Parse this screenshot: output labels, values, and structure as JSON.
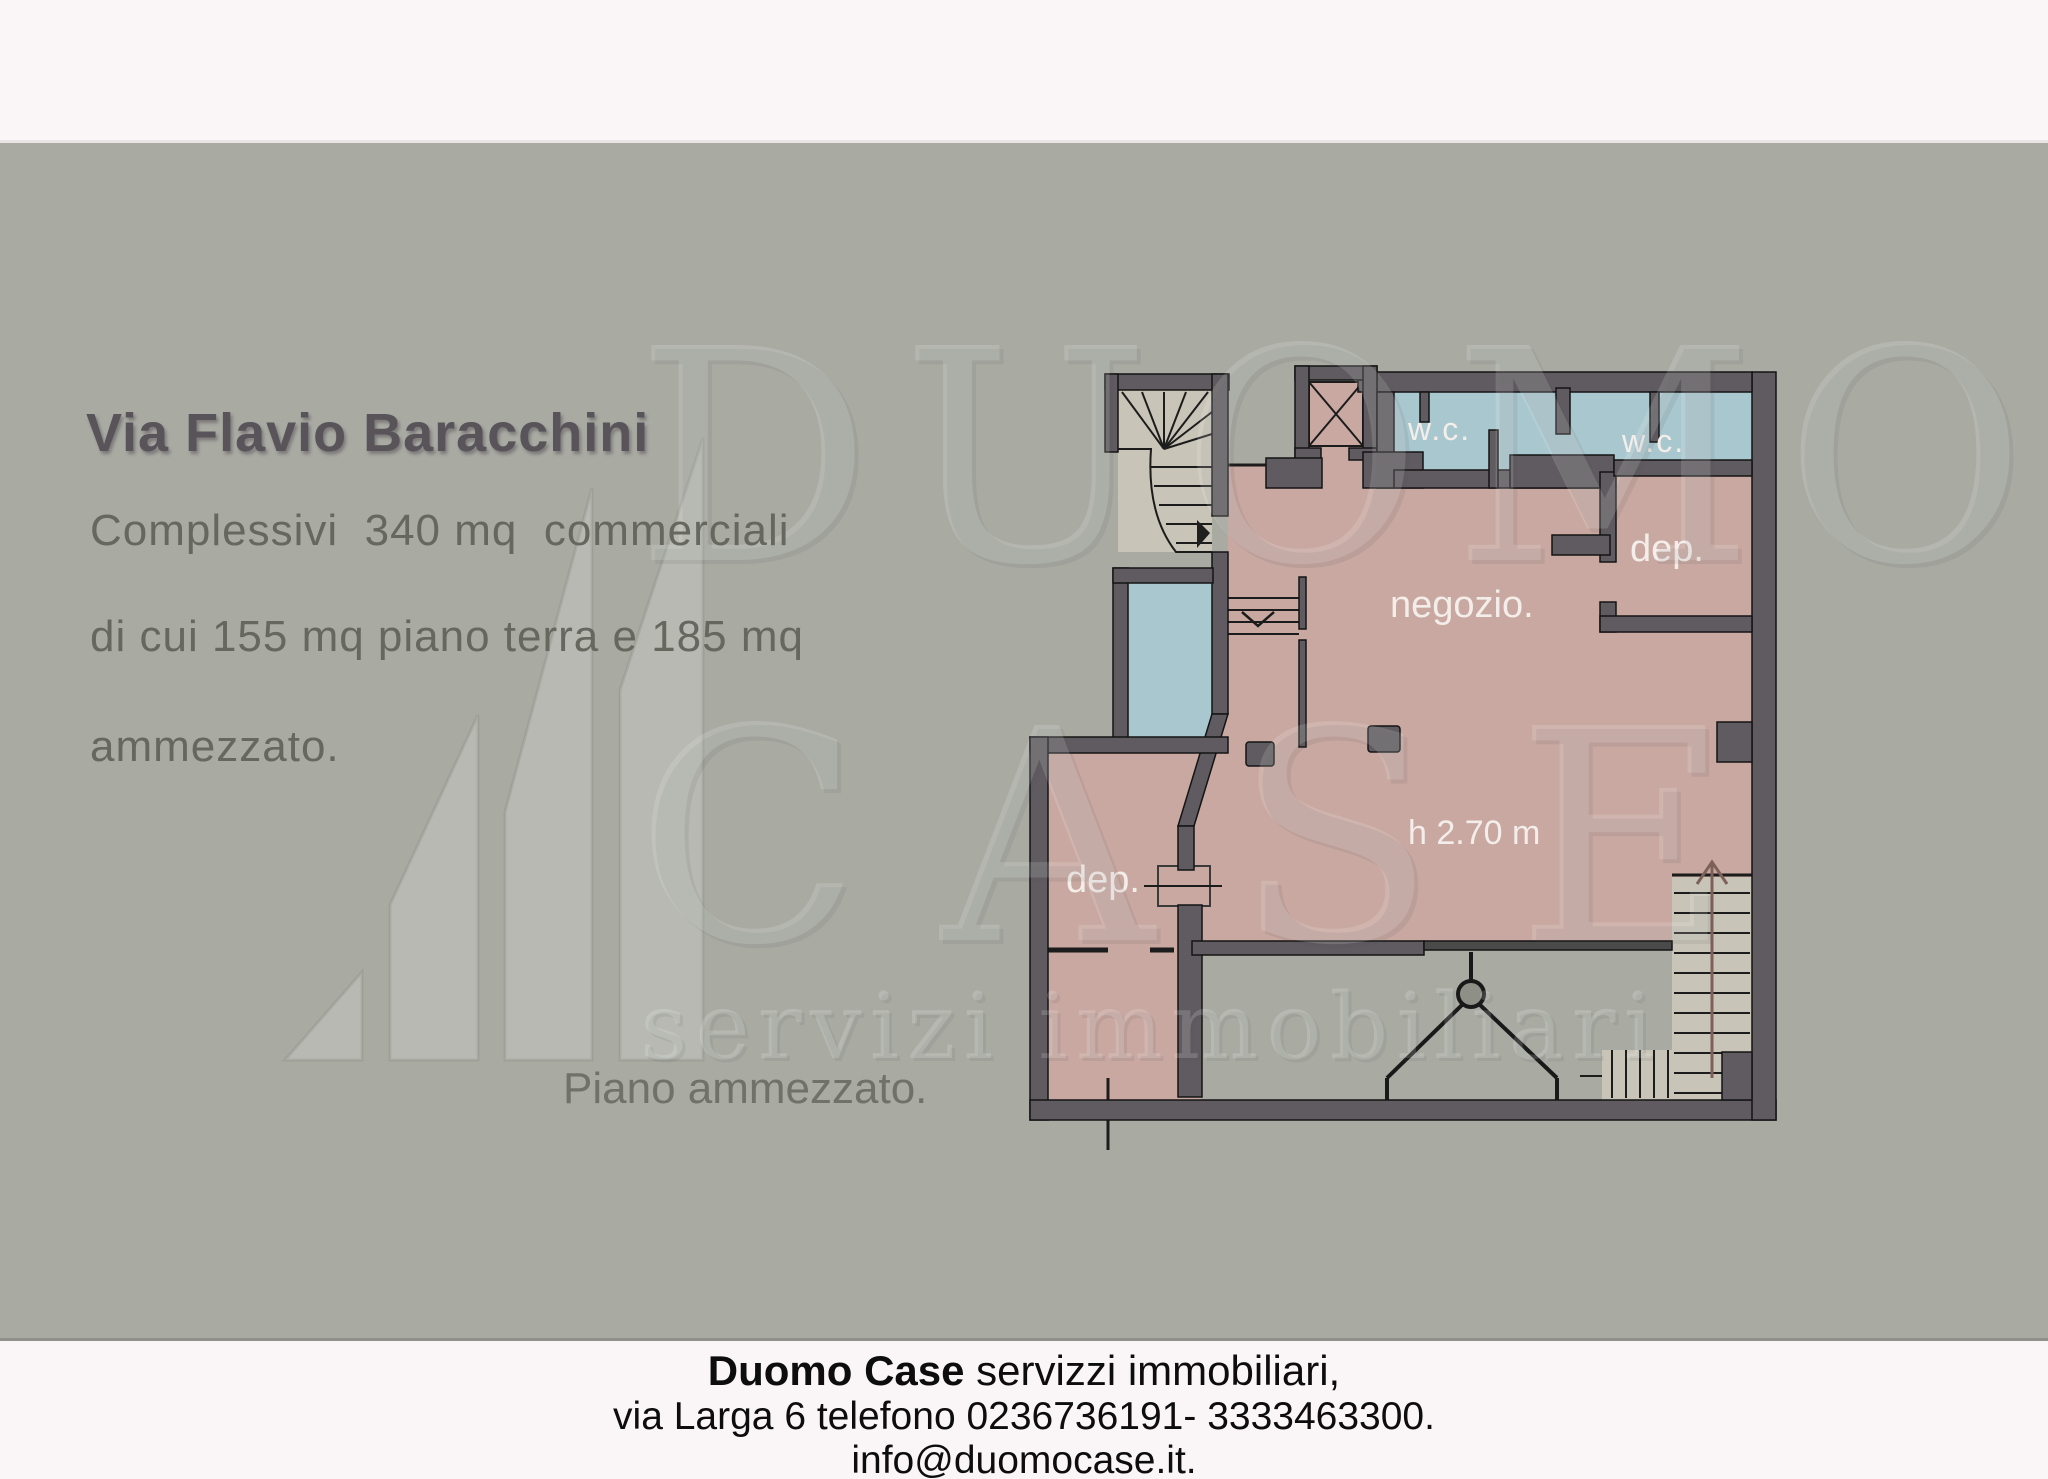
{
  "page": {
    "bg": "#a9aba3",
    "top_strip_bg": "#faf5f7",
    "footer_bg": "#faf6f7"
  },
  "listing": {
    "title": "Via Flavio Baracchini",
    "line1": "Complessivi  340 mq  commerciali",
    "line2": "di cui 155 mq piano terra e 185 mq",
    "line3": "ammezzato.",
    "floor_caption": "Piano ammezzato."
  },
  "floorplan": {
    "labels": {
      "wc1": "w.c.",
      "wc2": "w.c.",
      "dep_top": "dep.",
      "shop": "negozio.",
      "height": "h 2.70 m",
      "dep_bottom": "dep."
    },
    "colors": {
      "wall": "#5f5b60",
      "room_pink": "#c9a8a1",
      "room_blue": "#a9c7cf",
      "stairs": "#c9c4b8",
      "label_text": "#f4eeea"
    }
  },
  "watermark": {
    "row1": "DUOMO",
    "row2": "CASE",
    "row3": "servizi immobiliari"
  },
  "footer": {
    "agency_bold": "Duomo Case",
    "agency_rest": " servizzi immobiliari,",
    "address_phone": "via Larga 6 telefono 0236736191- 3333463300.",
    "email": "info@duomocase.it."
  }
}
